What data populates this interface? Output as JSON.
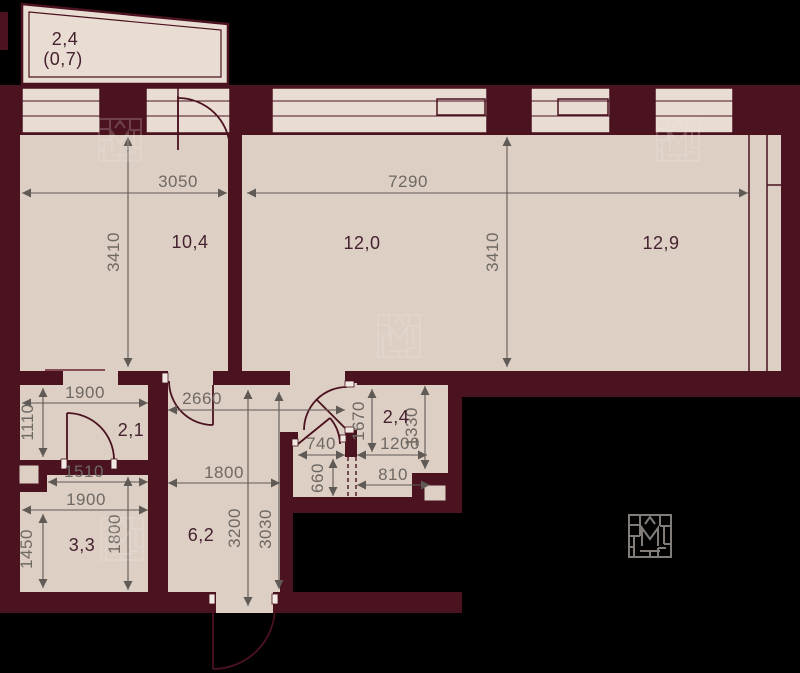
{
  "title": "apartment-floor-plan",
  "balcony": {
    "area": "2,4",
    "area_reduced": "(0,7)"
  },
  "rooms": {
    "room_10_4": "10,4",
    "room_12_0": "12,0",
    "room_12_9": "12,9",
    "hall_2_1": "2,1",
    "bathroom_2_4": "2,4",
    "corridor_6_2": "6,2",
    "bathroom_3_3": "3,3"
  },
  "dimensions_mm": {
    "d3050": "3050",
    "d7290": "7290",
    "d3410_left": "3410",
    "d3410_right": "3410",
    "d1900_hall": "1900",
    "d1110": "1110",
    "d1510": "1510",
    "d1900_bath": "1900",
    "d1450": "1450",
    "d1800_bath": "1800",
    "d2660": "2660",
    "d1800_corridor": "1800",
    "d3200": "3200",
    "d3030": "3030",
    "d1670": "1670",
    "d1330": "1330",
    "d1200": "1200",
    "d810": "810",
    "d740": "740",
    "d660": "660"
  },
  "colors": {
    "background": "#000000",
    "wall": "#4b1220",
    "room_fill": "#ddcfc4",
    "window_fill": "#e9ddd3",
    "dim_text": "#6f6964",
    "room_text": "#45222f",
    "dim_line": "#5f5a56",
    "watermark": "#8f8a85"
  }
}
